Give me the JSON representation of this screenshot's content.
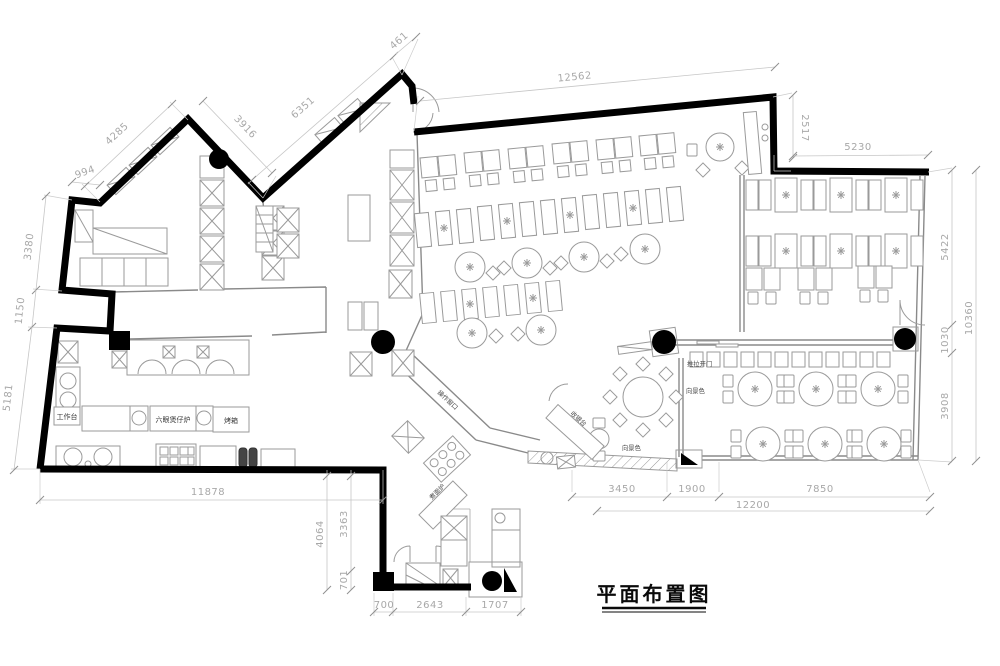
{
  "title": "平面布置图",
  "labels": {
    "workbench": "工作台",
    "six_burner_stove": "六眼煲仔炉",
    "oven": "烤箱",
    "noodle_stove": "煮面炉",
    "service_window": "操作窗口",
    "cashier_counter": "收银台",
    "sliding_door": "推拉开门",
    "scenery_view_1": "向景色",
    "scenery_view_2": "向景色"
  },
  "dimensions_mm": {
    "top": {
      "d994": "994",
      "d4285": "4285",
      "d3916": "3916",
      "d6351": "6351",
      "d461": "461",
      "d12562": "12562",
      "d2517": "2517",
      "d5230": "5230"
    },
    "left": {
      "d3380": "3380",
      "d1150": "1150",
      "d5181": "5181"
    },
    "right": {
      "d5422": "5422",
      "d1030": "1030",
      "d3908": "3908",
      "d10360": "10360"
    },
    "bottom": {
      "d11878": "11878",
      "d4064": "4064",
      "d3363": "3363",
      "d701": "701",
      "d700": "700",
      "d2643": "2643",
      "d1707": "1707",
      "d3450": "3450",
      "d1900": "1900",
      "d7850": "7850",
      "d12200": "12200"
    }
  },
  "colors": {
    "wall": "#000000",
    "furniture_line": "#9a9a9a",
    "dim_text": "#a8a8a8",
    "label_text": "#3a3a3a",
    "column": "#000000"
  }
}
